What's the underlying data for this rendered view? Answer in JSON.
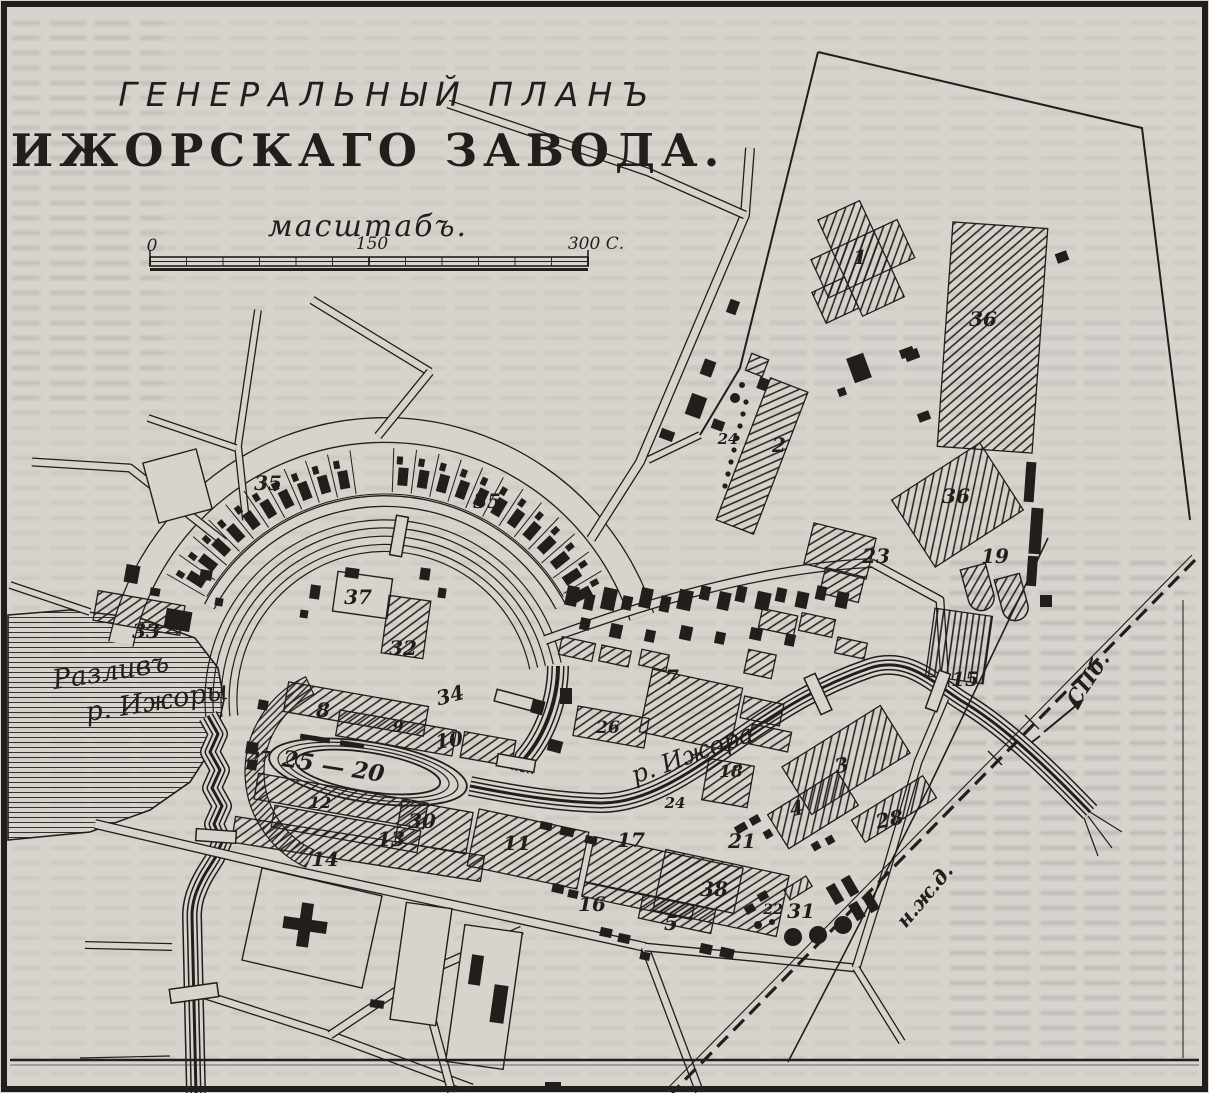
{
  "map": {
    "title_line1": "ГЕНЕРАЛЬНЫЙ ПЛАНЪ",
    "title_line2": "ИЖОРСКАГО ЗАВОДА.",
    "scale": {
      "caption": "масштабъ.",
      "ticks": [
        "0",
        "150",
        "300 С."
      ]
    },
    "water_labels": [
      {
        "text": "Разливъ",
        "x": 112,
        "y": 680,
        "rot": -9,
        "size": 27
      },
      {
        "text": "р. Ижоры",
        "x": 158,
        "y": 710,
        "rot": -9,
        "size": 27
      },
      {
        "text": "р. Ижора",
        "x": 695,
        "y": 762,
        "rot": -20,
        "size": 25
      }
    ],
    "route_labels": [
      {
        "text": "СПб.",
        "x": 1094,
        "y": 683,
        "rot": -56,
        "size": 21
      },
      {
        "text": "н.ж.д.",
        "x": 930,
        "y": 900,
        "rot": -50,
        "size": 20
      }
    ],
    "building_numbers": [
      {
        "n": "35",
        "x": 268,
        "y": 490
      },
      {
        "n": "35",
        "x": 487,
        "y": 508
      },
      {
        "n": "33",
        "x": 146,
        "y": 638
      },
      {
        "n": "37",
        "x": 358,
        "y": 604
      },
      {
        "n": "32",
        "x": 403,
        "y": 655
      },
      {
        "n": "34",
        "x": 452,
        "y": 702,
        "rot": -15
      },
      {
        "n": "1",
        "x": 860,
        "y": 264
      },
      {
        "n": "36",
        "x": 983,
        "y": 326
      },
      {
        "n": "24",
        "x": 728,
        "y": 444,
        "s": 15
      },
      {
        "n": "2",
        "x": 779,
        "y": 452
      },
      {
        "n": "36",
        "x": 956,
        "y": 503
      },
      {
        "n": "23",
        "x": 876,
        "y": 563
      },
      {
        "n": "19",
        "x": 995,
        "y": 563
      },
      {
        "n": "15",
        "x": 965,
        "y": 686
      },
      {
        "n": "28",
        "x": 891,
        "y": 826,
        "rot": -12
      },
      {
        "n": "3",
        "x": 843,
        "y": 772,
        "rot": -12
      },
      {
        "n": "4",
        "x": 798,
        "y": 815,
        "rot": -12
      },
      {
        "n": "18",
        "x": 731,
        "y": 777,
        "s": 17
      },
      {
        "n": "24",
        "x": 675,
        "y": 808,
        "s": 15
      },
      {
        "n": "21",
        "x": 742,
        "y": 848
      },
      {
        "n": "17",
        "x": 631,
        "y": 847
      },
      {
        "n": "38",
        "x": 714,
        "y": 896
      },
      {
        "n": "5",
        "x": 671,
        "y": 930
      },
      {
        "n": "16",
        "x": 592,
        "y": 911
      },
      {
        "n": "22",
        "x": 773,
        "y": 914,
        "s": 14
      },
      {
        "n": "31",
        "x": 801,
        "y": 918
      },
      {
        "n": "26",
        "x": 608,
        "y": 733,
        "s": 17
      },
      {
        "n": "7",
        "x": 672,
        "y": 684
      },
      {
        "n": "11",
        "x": 517,
        "y": 850
      },
      {
        "n": "13",
        "x": 391,
        "y": 846
      },
      {
        "n": "30",
        "x": 422,
        "y": 828
      },
      {
        "n": "12",
        "x": 320,
        "y": 808,
        "s": 16
      },
      {
        "n": "14",
        "x": 325,
        "y": 866
      },
      {
        "n": "27",
        "x": 260,
        "y": 762,
        "s": 15
      },
      {
        "n": "8",
        "x": 323,
        "y": 717
      },
      {
        "n": "9",
        "x": 398,
        "y": 732,
        "s": 16
      },
      {
        "n": "10",
        "x": 450,
        "y": 747,
        "rot": -8
      },
      {
        "n": "25 — 20",
        "x": 332,
        "y": 774,
        "rot": 9,
        "s": 23
      }
    ],
    "colors": {
      "paper": "#d7d4ce",
      "ink": "#211f1b"
    }
  }
}
